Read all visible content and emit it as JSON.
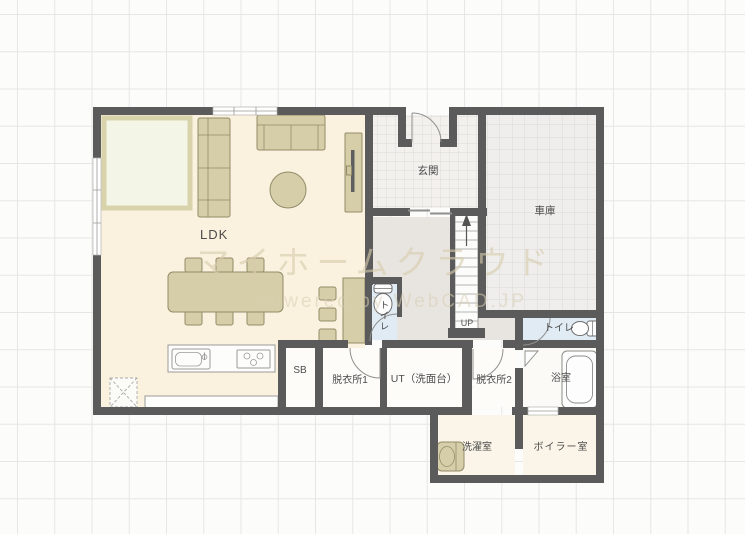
{
  "watermark": {
    "line1": "マイホームクラウド",
    "line2": "powered by WebCAD.JP"
  },
  "rooms": {
    "ldk": {
      "label": "LDK"
    },
    "genkan": {
      "label": "玄関"
    },
    "garage": {
      "label": "車庫"
    },
    "shoe_box": {
      "label": "SB"
    },
    "dressing1": {
      "label": "脱衣所1"
    },
    "utility": {
      "label": "UT（洗面台）"
    },
    "dressing2": {
      "label": "脱衣所2"
    },
    "toilet_hall": {
      "label": "トイレ"
    },
    "toilet_upper": {
      "label": "トイレ"
    },
    "bathroom": {
      "label": "浴室"
    },
    "laundry": {
      "label": "洗濯室"
    },
    "boiler": {
      "label": "ボイラー室"
    }
  },
  "stairs": {
    "direction_label": "UP"
  },
  "colors": {
    "wall": "#5b5b5b",
    "ldk_floor": "#faf2df",
    "hall_floor": "#e8e5e0",
    "entrance_tile": "#f3f1ed",
    "garage_tile": "#efeeec",
    "wet_room_floor": "#fdfcf8",
    "toilet_floor": "#e1ebf3",
    "extension_floor": "#faf5e8",
    "furniture": "#d6cea8",
    "furniture_outline": "#938c69",
    "rug": "#f3f5e7",
    "rug_border": "#d9d3ab",
    "grid_line": "#e6e6e6"
  }
}
